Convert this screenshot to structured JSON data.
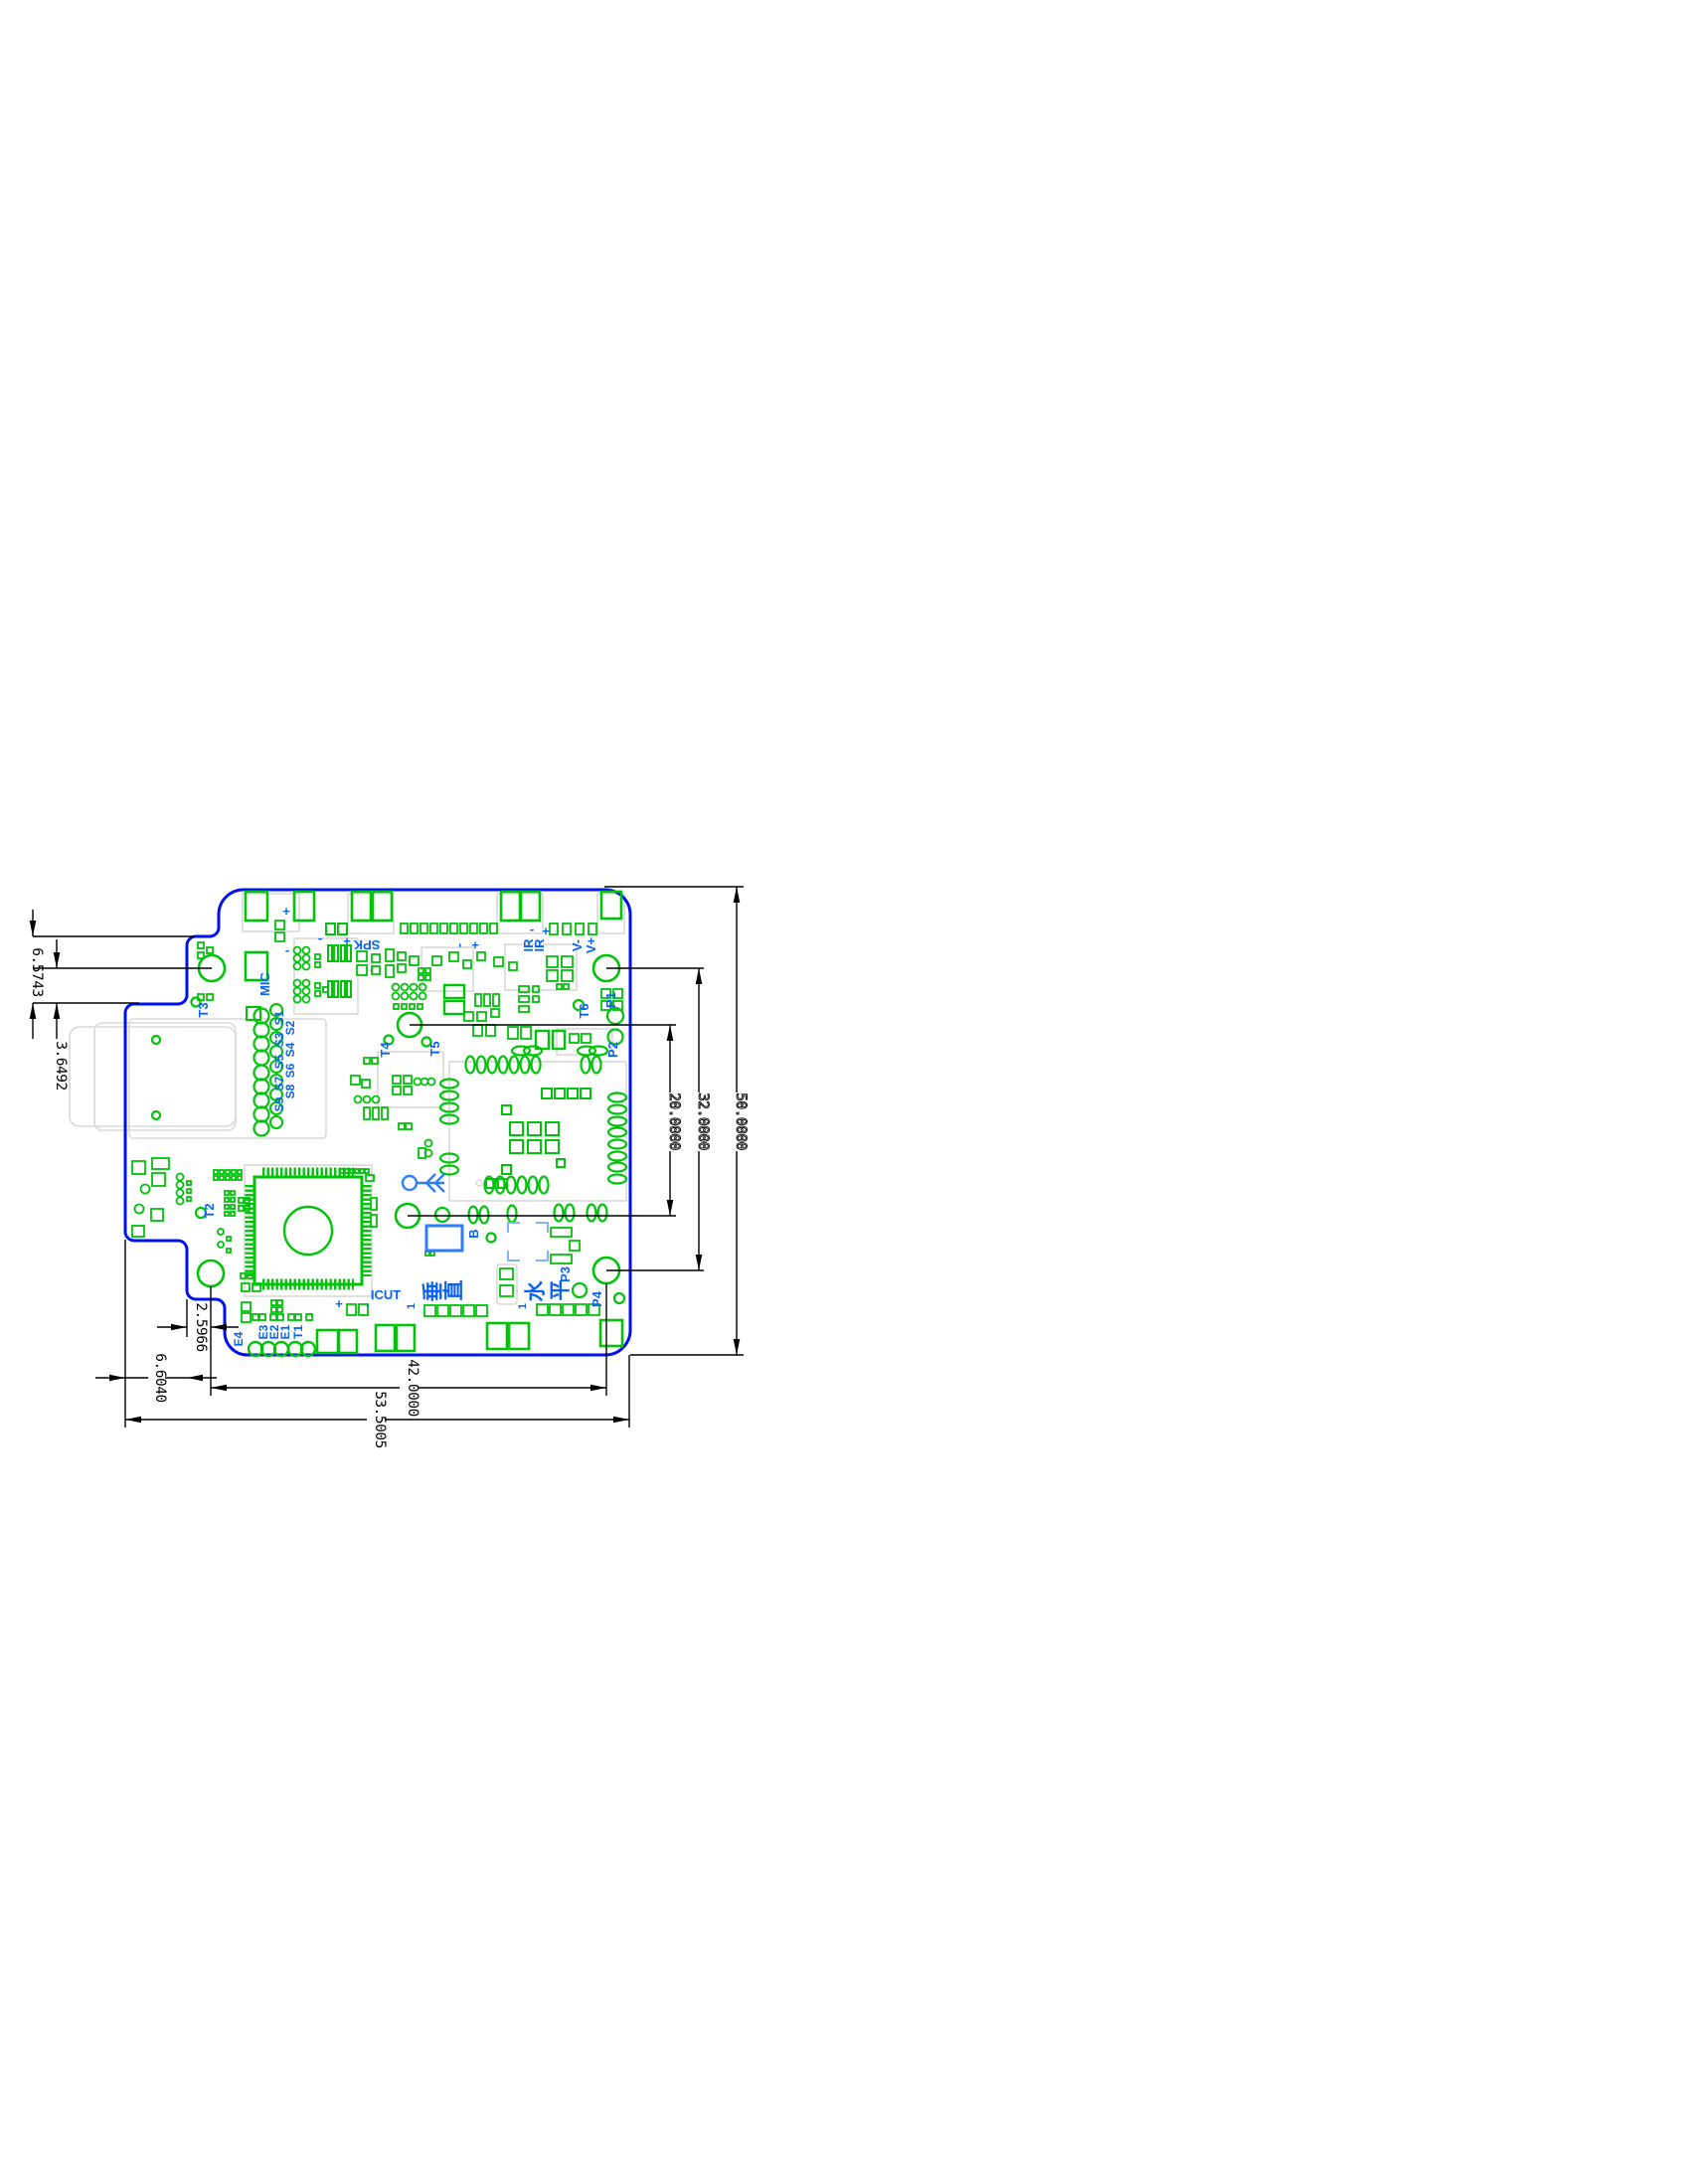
{
  "drawing_type": "pcb-dimension-drawing",
  "dims": {
    "left_step": "6.5743",
    "left_hole": "3.6492",
    "bottom_hole_to_edge": "2.5966",
    "bottom_left_step": "6.6040",
    "hole_span_horizontal": "42.0000",
    "board_width": "53.5005",
    "hole_span_inner": "20.0000",
    "hole_span_outer": "32.0000",
    "board_height": "50.0000"
  },
  "silkscreen": {
    "t1": "T1",
    "t2": "T2",
    "t3": "T3",
    "t4": "T4",
    "t5": "T5",
    "t6": "T6",
    "p1": "P1",
    "p2": "P2",
    "p3": "P3",
    "p4": "P4",
    "s": [
      "S1",
      "S2",
      "S3",
      "S4",
      "S5",
      "S6",
      "S7",
      "S8",
      "S9"
    ],
    "e": [
      "E1",
      "E2",
      "E3",
      "E4"
    ],
    "mic": "MIC",
    "spk": "SPK",
    "ir": "IR",
    "v_plus": "V+",
    "v_minus": "V-",
    "icut": "ICUT",
    "b": "B",
    "pin1": "1",
    "plus": "+",
    "minus": "-",
    "cjk_vertical": [
      "垂",
      "直"
    ],
    "cjk_horizontal": [
      "水",
      "平"
    ]
  },
  "colors": {
    "board_outline": "#0010f0",
    "copper": "#00c30a",
    "silkscreen": "#0a62f5",
    "component_blue": "#2e7ef5",
    "bracket_blue": "#85b4f2",
    "dimension": "#000000",
    "courtyard": "#d9d9d9"
  }
}
